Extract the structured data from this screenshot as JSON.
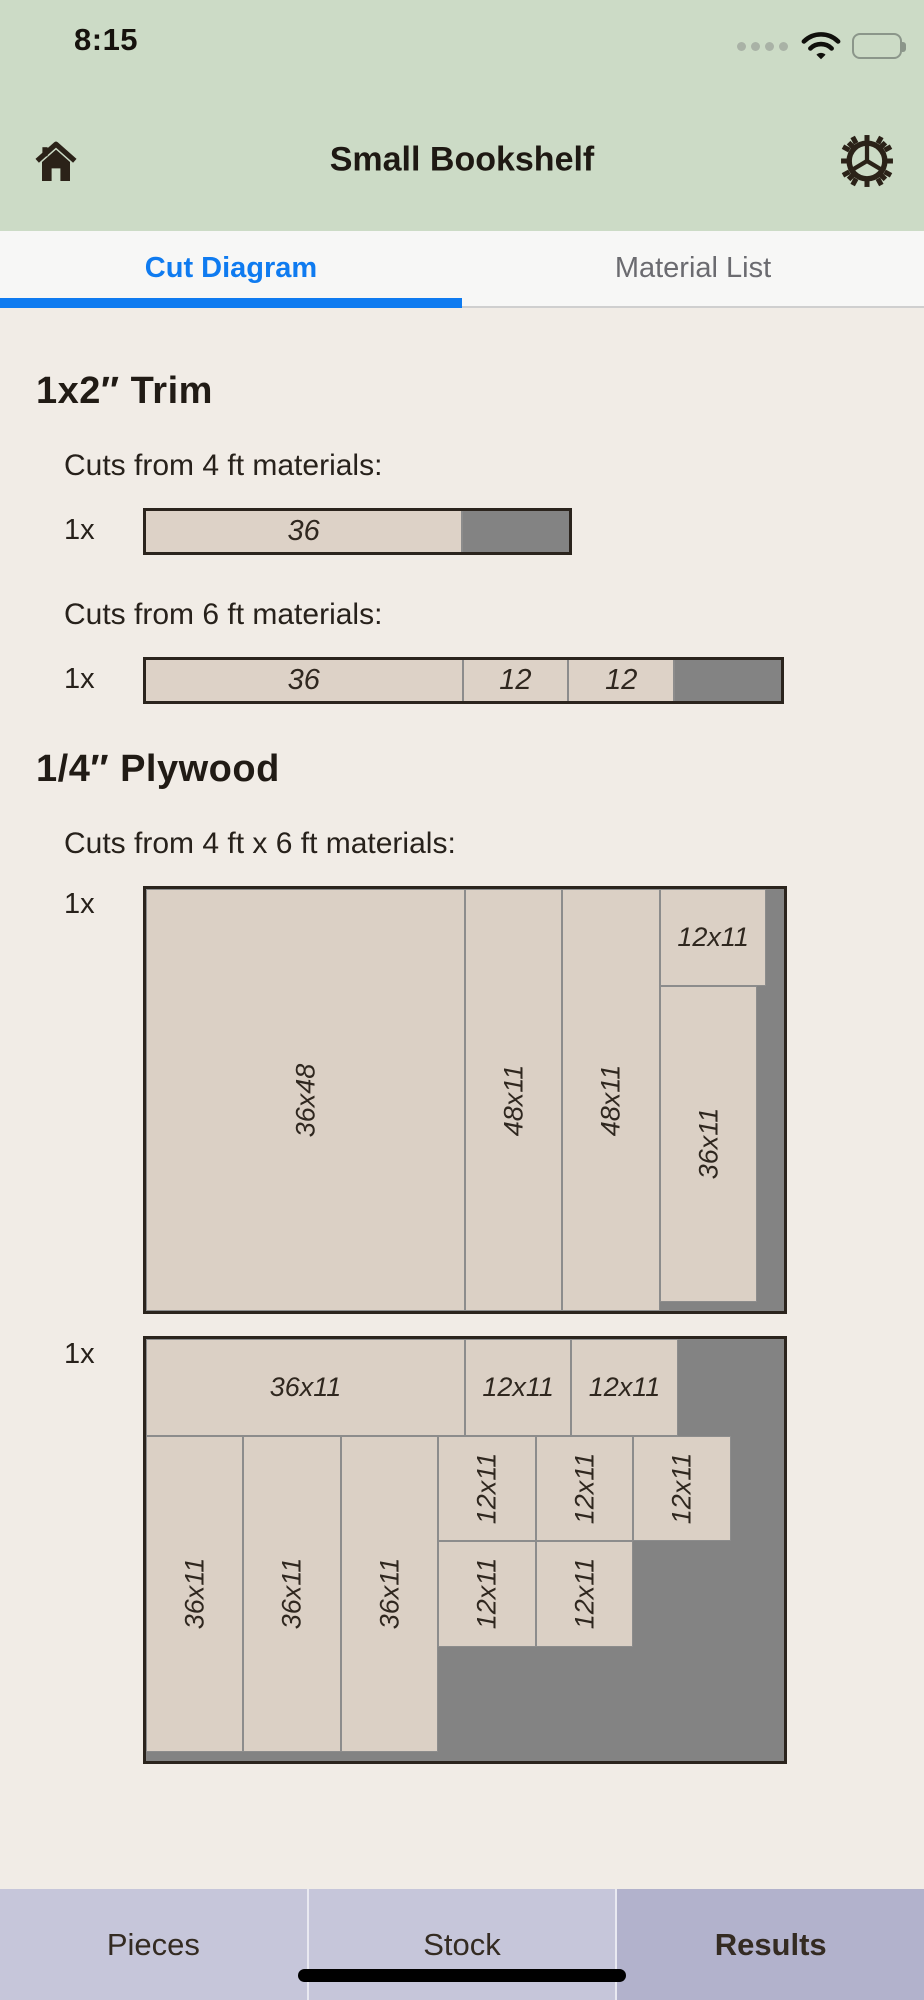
{
  "status_bar": {
    "time": "8:15"
  },
  "header": {
    "title": "Small Bookshelf"
  },
  "tabs": {
    "cut_diagram": "Cut Diagram",
    "material_list": "Material List"
  },
  "trim": {
    "heading": "1x2″ Trim",
    "group4": {
      "label": "Cuts from 4 ft materials:",
      "count": "1x",
      "pieces": [
        "36"
      ]
    },
    "group6": {
      "label": "Cuts from 6 ft materials:",
      "count": "1x",
      "pieces": [
        "36",
        "12",
        "12"
      ]
    }
  },
  "plywood": {
    "heading": "1/4″ Plywood",
    "label": "Cuts from 4 ft x 6 ft materials:",
    "sheets": [
      {
        "count": "1x",
        "pieces": [
          "36x48",
          "48x11",
          "48x11",
          "12x11",
          "36x11"
        ]
      },
      {
        "count": "1x",
        "pieces": [
          "36x11",
          "12x11",
          "12x11",
          "36x11",
          "36x11",
          "36x11",
          "12x11",
          "12x11",
          "12x11",
          "12x11",
          "12x11"
        ]
      }
    ]
  },
  "bottom_tabs": {
    "pieces": "Pieces",
    "stock": "Stock",
    "results": "Results"
  },
  "colors": {
    "accent_blue": "#0f7bf0",
    "header_green": "#ccdbc6",
    "content_bg": "#f1ece6",
    "piece_beige": "#dbd0c5",
    "waste_gray": "#838383",
    "outline_dark": "#2b241d",
    "bottom_bar": "#c6c6da",
    "bottom_bar_active": "#b2b2cc"
  }
}
